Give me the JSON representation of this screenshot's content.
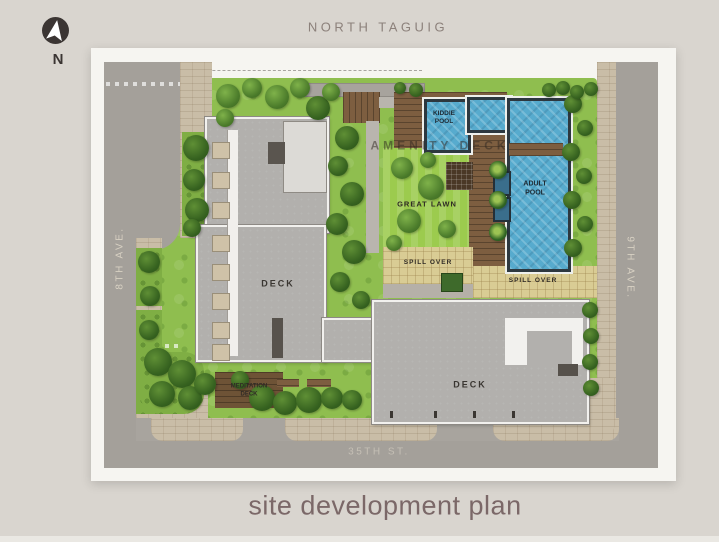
{
  "page": {
    "title": "site development plan",
    "background": "#d9d5cf",
    "title_color": "#7b6868"
  },
  "compass": {
    "letter": "N"
  },
  "streets": {
    "north_label": "NORTH TAGUIG",
    "west_label": "8TH AVE.",
    "east_label": "9TH AVE.",
    "south_label": "35TH ST."
  },
  "plan": {
    "labels": {
      "amenity_deck": "AMENITY DECK",
      "kiddie_pool": "KIDDIE POOL",
      "adult_pool": "ADULT POOL",
      "great_lawn": "GREAT LAWN",
      "spill_over_upper": "SPILL OVER",
      "spill_over_lower": "SPILL OVER",
      "deck_west": "DECK",
      "deck_east": "DECK",
      "meditation_deck": "MEDITATION DECK"
    },
    "colors": {
      "bg": "#d9d5cf",
      "sheet": "#f6f5f1",
      "road": "#a4a09a",
      "sidewalk": "#c9bda7",
      "grass": "#8fbe4f",
      "lawn": "#9ccb4e",
      "wood": "#7d5e40",
      "water": "#57abce",
      "building": "#b2b0ad",
      "spill": "#d9cc94",
      "title": "#7b6868"
    }
  }
}
